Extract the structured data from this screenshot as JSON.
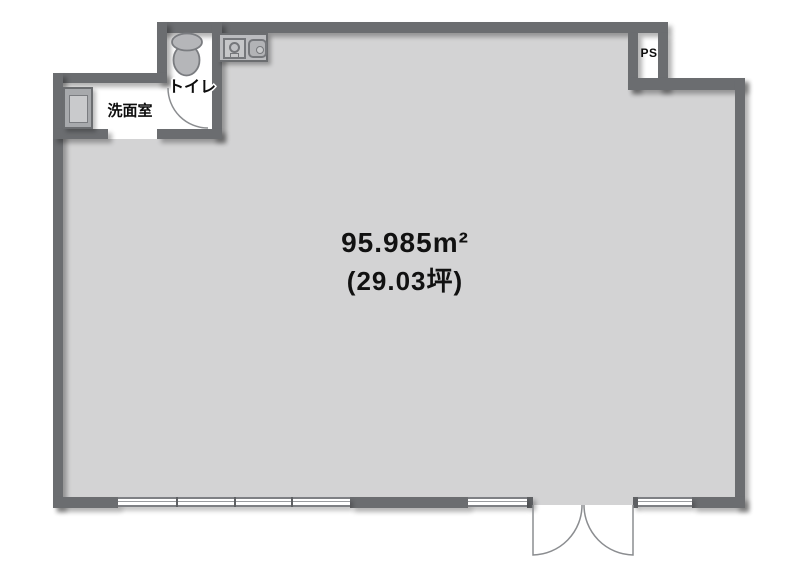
{
  "plan": {
    "area": {
      "m2": "95.985m²",
      "tsubo": "(29.03坪)"
    },
    "rooms": {
      "toilet": "トイレ",
      "washroom": "洗面室",
      "pipe_space": "PS"
    },
    "icons": {
      "toilet": "toilet-icon",
      "washbasin": "washbasin-icon",
      "kitchen_sink": "kitchen-sink-icon",
      "entrance": "double-door-icon",
      "windows": "window-icon"
    },
    "colors": {
      "wall": "#6b6d70",
      "floor": "#d3d3d4",
      "interior": "#ffffff",
      "fixture_fill": "#b5b6b9",
      "fixture_stroke": "#7a7c80",
      "text": "#0d0d0d"
    }
  }
}
